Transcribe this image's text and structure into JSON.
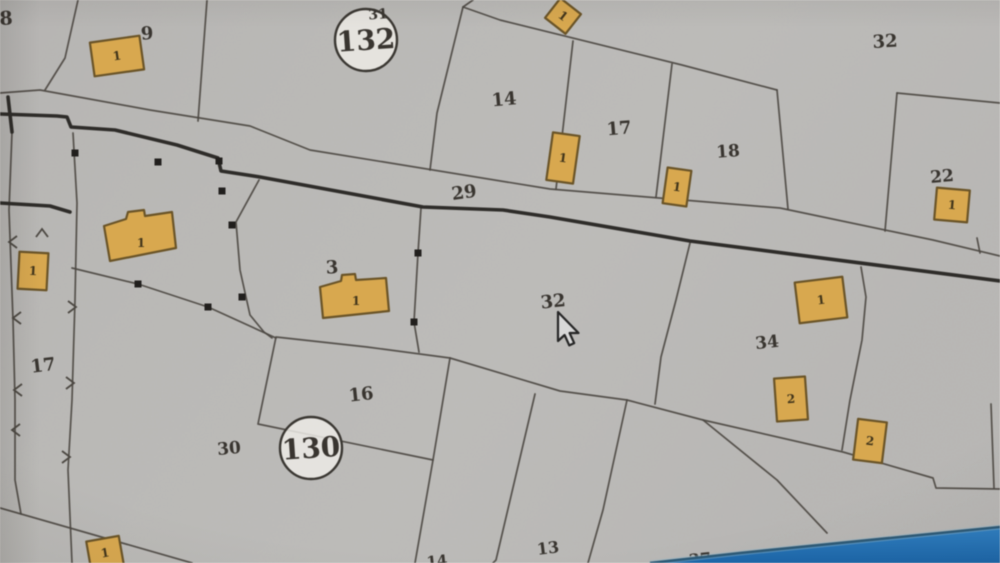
{
  "screen": {
    "width": 1000,
    "height": 563,
    "description": "photo of a monitor displaying a cadastral parcel map"
  },
  "map": {
    "paper_color_light": "#efedе9",
    "paper_color": "#eceae5",
    "line_color": "#4c4842",
    "thick_line_color": "#2e2c29",
    "building_fill": "#d9a84c",
    "building_stroke": "#6b5426",
    "building_label_color": "#42351a",
    "label_color": "#393530",
    "road_label": "29",
    "parcel_labels": [
      {
        "text": "8",
        "x": 6,
        "y": 18,
        "size": 19,
        "rot": -3
      },
      {
        "text": "9",
        "x": 147,
        "y": 33,
        "size": 18,
        "rot": -4
      },
      {
        "text": "31",
        "x": 378,
        "y": 14,
        "size": 14,
        "rot": -4
      },
      {
        "text": "14",
        "x": 504,
        "y": 99,
        "size": 18,
        "rot": -5
      },
      {
        "text": "17",
        "x": 619,
        "y": 128,
        "size": 18,
        "rot": -5
      },
      {
        "text": "18",
        "x": 728,
        "y": 151,
        "size": 17,
        "rot": -4
      },
      {
        "text": "32",
        "x": 885,
        "y": 41,
        "size": 18,
        "rot": -3
      },
      {
        "text": "22",
        "x": 942,
        "y": 176,
        "size": 17,
        "rot": -5
      },
      {
        "text": "29",
        "x": 464,
        "y": 192,
        "size": 18,
        "rot": -8
      },
      {
        "text": "3",
        "x": 332,
        "y": 267,
        "size": 18,
        "rot": -3
      },
      {
        "text": "32",
        "x": 553,
        "y": 301,
        "size": 18,
        "rot": -6
      },
      {
        "text": "34",
        "x": 767,
        "y": 342,
        "size": 17,
        "rot": -6
      },
      {
        "text": "17",
        "x": 43,
        "y": 365,
        "size": 18,
        "rot": -7
      },
      {
        "text": "16",
        "x": 361,
        "y": 394,
        "size": 18,
        "rot": -6
      },
      {
        "text": "30",
        "x": 229,
        "y": 448,
        "size": 17,
        "rot": -5
      },
      {
        "text": "13",
        "x": 548,
        "y": 548,
        "size": 16,
        "rot": -7
      },
      {
        "text": "14",
        "x": 437,
        "y": 561,
        "size": 15,
        "rot": -6
      },
      {
        "text": "37",
        "x": 700,
        "y": 559,
        "size": 16,
        "rot": -6
      }
    ],
    "block_circles": [
      {
        "number": "132",
        "sup": "31",
        "cx": 366,
        "cy": 40,
        "r": 31,
        "num_size": 28
      },
      {
        "number": "130",
        "sup": "",
        "cx": 311,
        "cy": 448,
        "r": 31,
        "num_size": 28
      }
    ],
    "buildings": [
      {
        "label": "1",
        "cx": 117,
        "cy": 56,
        "w": 50,
        "h": 34,
        "rot": -8
      },
      {
        "label": "1",
        "cx": 563,
        "cy": 16,
        "w": 26,
        "h": 25,
        "rot": 38
      },
      {
        "label": "1",
        "cx": 563,
        "cy": 158,
        "w": 27,
        "h": 48,
        "rot": 8
      },
      {
        "label": "1",
        "cx": 677,
        "cy": 187,
        "w": 24,
        "h": 36,
        "rot": 8
      },
      {
        "label": "1",
        "cx": 952,
        "cy": 205,
        "w": 33,
        "h": 32,
        "rot": 5
      },
      {
        "label": "1",
        "points": [
          [
            104,
            226
          ],
          [
            126,
            219
          ],
          [
            128,
            212
          ],
          [
            144,
            210
          ],
          [
            145,
            216
          ],
          [
            172,
            212
          ],
          [
            176,
            248
          ],
          [
            110,
            261
          ]
        ],
        "lx": 141,
        "ly": 243
      },
      {
        "label": "1",
        "cx": 33,
        "cy": 271,
        "w": 29,
        "h": 37,
        "rot": 3
      },
      {
        "label": "1",
        "points": [
          [
            320,
            287
          ],
          [
            341,
            281
          ],
          [
            342,
            275
          ],
          [
            355,
            274
          ],
          [
            356,
            280
          ],
          [
            386,
            278
          ],
          [
            389,
            311
          ],
          [
            323,
            318
          ]
        ],
        "lx": 356,
        "ly": 301
      },
      {
        "label": "1",
        "cx": 821,
        "cy": 300,
        "w": 48,
        "h": 41,
        "rot": -7
      },
      {
        "label": "2",
        "cx": 791,
        "cy": 399,
        "w": 31,
        "h": 43,
        "rot": -4
      },
      {
        "label": "2",
        "cx": 870,
        "cy": 441,
        "w": 29,
        "h": 41,
        "rot": 7
      },
      {
        "label": "1",
        "cx": 105,
        "cy": 553,
        "w": 33,
        "h": 29,
        "rot": -10
      }
    ],
    "thin_lines": [
      [
        [
          78,
          0
        ],
        [
          65,
          58
        ],
        [
          45,
          90
        ]
      ],
      [
        [
          207,
          0
        ],
        [
          198,
          121
        ]
      ],
      [
        [
          0,
          93
        ],
        [
          40,
          90
        ],
        [
          150,
          110
        ],
        [
          250,
          126
        ],
        [
          310,
          150
        ],
        [
          550,
          189
        ],
        [
          780,
          208
        ],
        [
          933,
          240
        ],
        [
          1000,
          256
        ]
      ],
      [
        [
          473,
          0
        ],
        [
          463,
          7
        ],
        [
          437,
          113
        ],
        [
          430,
          170
        ]
      ],
      [
        [
          463,
          7
        ],
        [
          500,
          20
        ],
        [
          682,
          65
        ],
        [
          777,
          90
        ]
      ],
      [
        [
          573,
          41
        ],
        [
          556,
          189
        ]
      ],
      [
        [
          672,
          64
        ],
        [
          656,
          197
        ]
      ],
      [
        [
          777,
          90
        ],
        [
          788,
          209
        ]
      ],
      [
        [
          897,
          93
        ],
        [
          885,
          231
        ]
      ],
      [
        [
          897,
          93
        ],
        [
          1000,
          103
        ]
      ],
      [
        [
          977,
          238
        ],
        [
          980,
          253
        ]
      ],
      [
        [
          73,
          133
        ],
        [
          77,
          203
        ],
        [
          75,
          300
        ],
        [
          72,
          400
        ],
        [
          68,
          470
        ],
        [
          72,
          563
        ]
      ],
      [
        [
          12,
          132
        ],
        [
          9,
          210
        ],
        [
          13,
          320
        ],
        [
          15,
          400
        ],
        [
          15,
          480
        ],
        [
          21,
          514
        ]
      ],
      [
        [
          259,
          180
        ],
        [
          236,
          222
        ],
        [
          240,
          270
        ],
        [
          250,
          315
        ],
        [
          264,
          332
        ],
        [
          272,
          338
        ]
      ],
      [
        [
          72,
          268
        ],
        [
          138,
          284
        ],
        [
          208,
          307
        ],
        [
          276,
          338
        ]
      ],
      [
        [
          421,
          208
        ],
        [
          418,
          253
        ],
        [
          414,
          322
        ],
        [
          419,
          352
        ]
      ],
      [
        [
          276,
          337
        ],
        [
          367,
          347
        ],
        [
          450,
          358
        ],
        [
          433,
          460
        ],
        [
          258,
          424
        ],
        [
          276,
          337
        ]
      ],
      [
        [
          450,
          358
        ],
        [
          560,
          391
        ],
        [
          627,
          400
        ],
        [
          703,
          420
        ],
        [
          843,
          452
        ],
        [
          933,
          478
        ],
        [
          936,
          488
        ],
        [
          1000,
          489
        ]
      ],
      [
        [
          690,
          243
        ],
        [
          676,
          300
        ],
        [
          661,
          357
        ],
        [
          655,
          404
        ]
      ],
      [
        [
          535,
          394
        ],
        [
          496,
          560
        ],
        [
          493,
          563
        ]
      ],
      [
        [
          627,
          400
        ],
        [
          603,
          510
        ],
        [
          588,
          563
        ]
      ],
      [
        [
          703,
          420
        ],
        [
          777,
          480
        ],
        [
          827,
          533
        ]
      ],
      [
        [
          861,
          267
        ],
        [
          866,
          297
        ],
        [
          862,
          340
        ],
        [
          850,
          400
        ],
        [
          842,
          450
        ]
      ],
      [
        [
          991,
          404
        ],
        [
          994,
          488
        ]
      ],
      [
        [
          0,
          508
        ],
        [
          77,
          530
        ],
        [
          192,
          563
        ]
      ],
      [
        [
          433,
          460
        ],
        [
          415,
          563
        ]
      ]
    ],
    "thick_lines": [
      [
        [
          0,
          114
        ],
        [
          57,
          116
        ],
        [
          67,
          117
        ],
        [
          71,
          127
        ],
        [
          115,
          130
        ],
        [
          177,
          145
        ],
        [
          218,
          158
        ],
        [
          221,
          171
        ],
        [
          260,
          177
        ],
        [
          423,
          207
        ],
        [
          503,
          210
        ],
        [
          550,
          217
        ],
        [
          690,
          241
        ],
        [
          1000,
          281
        ]
      ],
      [
        [
          8,
          97
        ],
        [
          12,
          132
        ]
      ],
      [
        [
          0,
          203
        ],
        [
          50,
          206
        ],
        [
          70,
          212
        ]
      ]
    ],
    "survey_dots": [
      [
        75,
        153
      ],
      [
        158,
        162
      ],
      [
        219,
        161
      ],
      [
        222,
        191
      ],
      [
        232,
        225
      ],
      [
        242,
        297
      ],
      [
        138,
        284
      ],
      [
        208,
        307
      ],
      [
        418,
        253
      ],
      [
        414,
        322
      ]
    ],
    "slope_ticks": [
      {
        "x": 9,
        "y": 242,
        "angle": 180
      },
      {
        "x": 13,
        "y": 318,
        "angle": 180
      },
      {
        "x": 14,
        "y": 390,
        "angle": 180
      },
      {
        "x": 12,
        "y": 430,
        "angle": 180
      },
      {
        "x": 76,
        "y": 307,
        "angle": 0
      },
      {
        "x": 74,
        "y": 383,
        "angle": 0
      },
      {
        "x": 70,
        "y": 457,
        "angle": 0
      },
      {
        "x": 42,
        "y": 229,
        "angle": -90
      }
    ]
  },
  "cursor": {
    "tip_x": 558,
    "tip_y": 312,
    "fill": "#d8d8d8",
    "stroke": "#262626"
  },
  "taskbar": {
    "polygon": [
      [
        650,
        563
      ],
      [
        740,
        553
      ],
      [
        1000,
        527
      ],
      [
        1000,
        563
      ]
    ],
    "edge_points": [
      [
        650,
        563
      ],
      [
        740,
        553
      ],
      [
        1000,
        527
      ]
    ],
    "fill_top": "#2e80c4",
    "fill_bottom": "#1a66ab",
    "edge_color": "#2c5a78",
    "highlight_color": "#8fb4c8"
  }
}
